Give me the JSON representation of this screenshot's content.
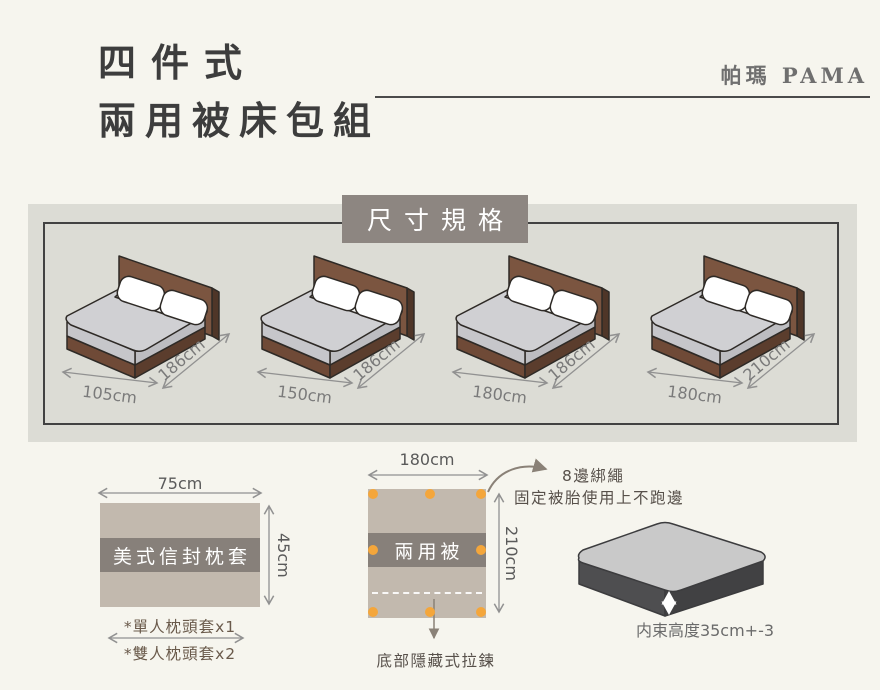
{
  "header": {
    "title_line1": "四件式",
    "title_line2": "兩用被床包組",
    "brand": "帕瑪 PAMA"
  },
  "size_section": {
    "heading": "尺寸規格",
    "beds": [
      {
        "width_label": "105cm",
        "length_label": "186cm"
      },
      {
        "width_label": "150cm",
        "length_label": "186cm"
      },
      {
        "width_label": "180cm",
        "length_label": "186cm"
      },
      {
        "width_label": "180cm",
        "length_label": "210cm"
      }
    ]
  },
  "pillow": {
    "width_label": "75cm",
    "height_label": "45cm",
    "label": "美式信封枕套",
    "note1": "*單人枕頭套x1",
    "note2": "*雙人枕頭套x2"
  },
  "quilt": {
    "width_label": "180cm",
    "height_label": "210cm",
    "label": "兩用被",
    "tie_title": "8邊綁繩",
    "tie_desc": "固定被胎使用上不跑邊",
    "zipper_label": "底部隱藏式拉鍊"
  },
  "mattress": {
    "height_note": "内束高度35cm+-3"
  },
  "colors": {
    "page_bg": "#f6f5ee",
    "panel_bg": "#dcdcd5",
    "heading_bg": "#8d8681",
    "swatch_bg": "#c2b9ae",
    "band_bg": "#87807a",
    "dot_orange": "#f4a63b",
    "headboard_brown": "#7b5540",
    "base_brown": "#6f4a37",
    "duvet_gray": "#d0d0d3",
    "mattress_side": "#4e4e50",
    "rule_dark": "#4b4b4b"
  }
}
